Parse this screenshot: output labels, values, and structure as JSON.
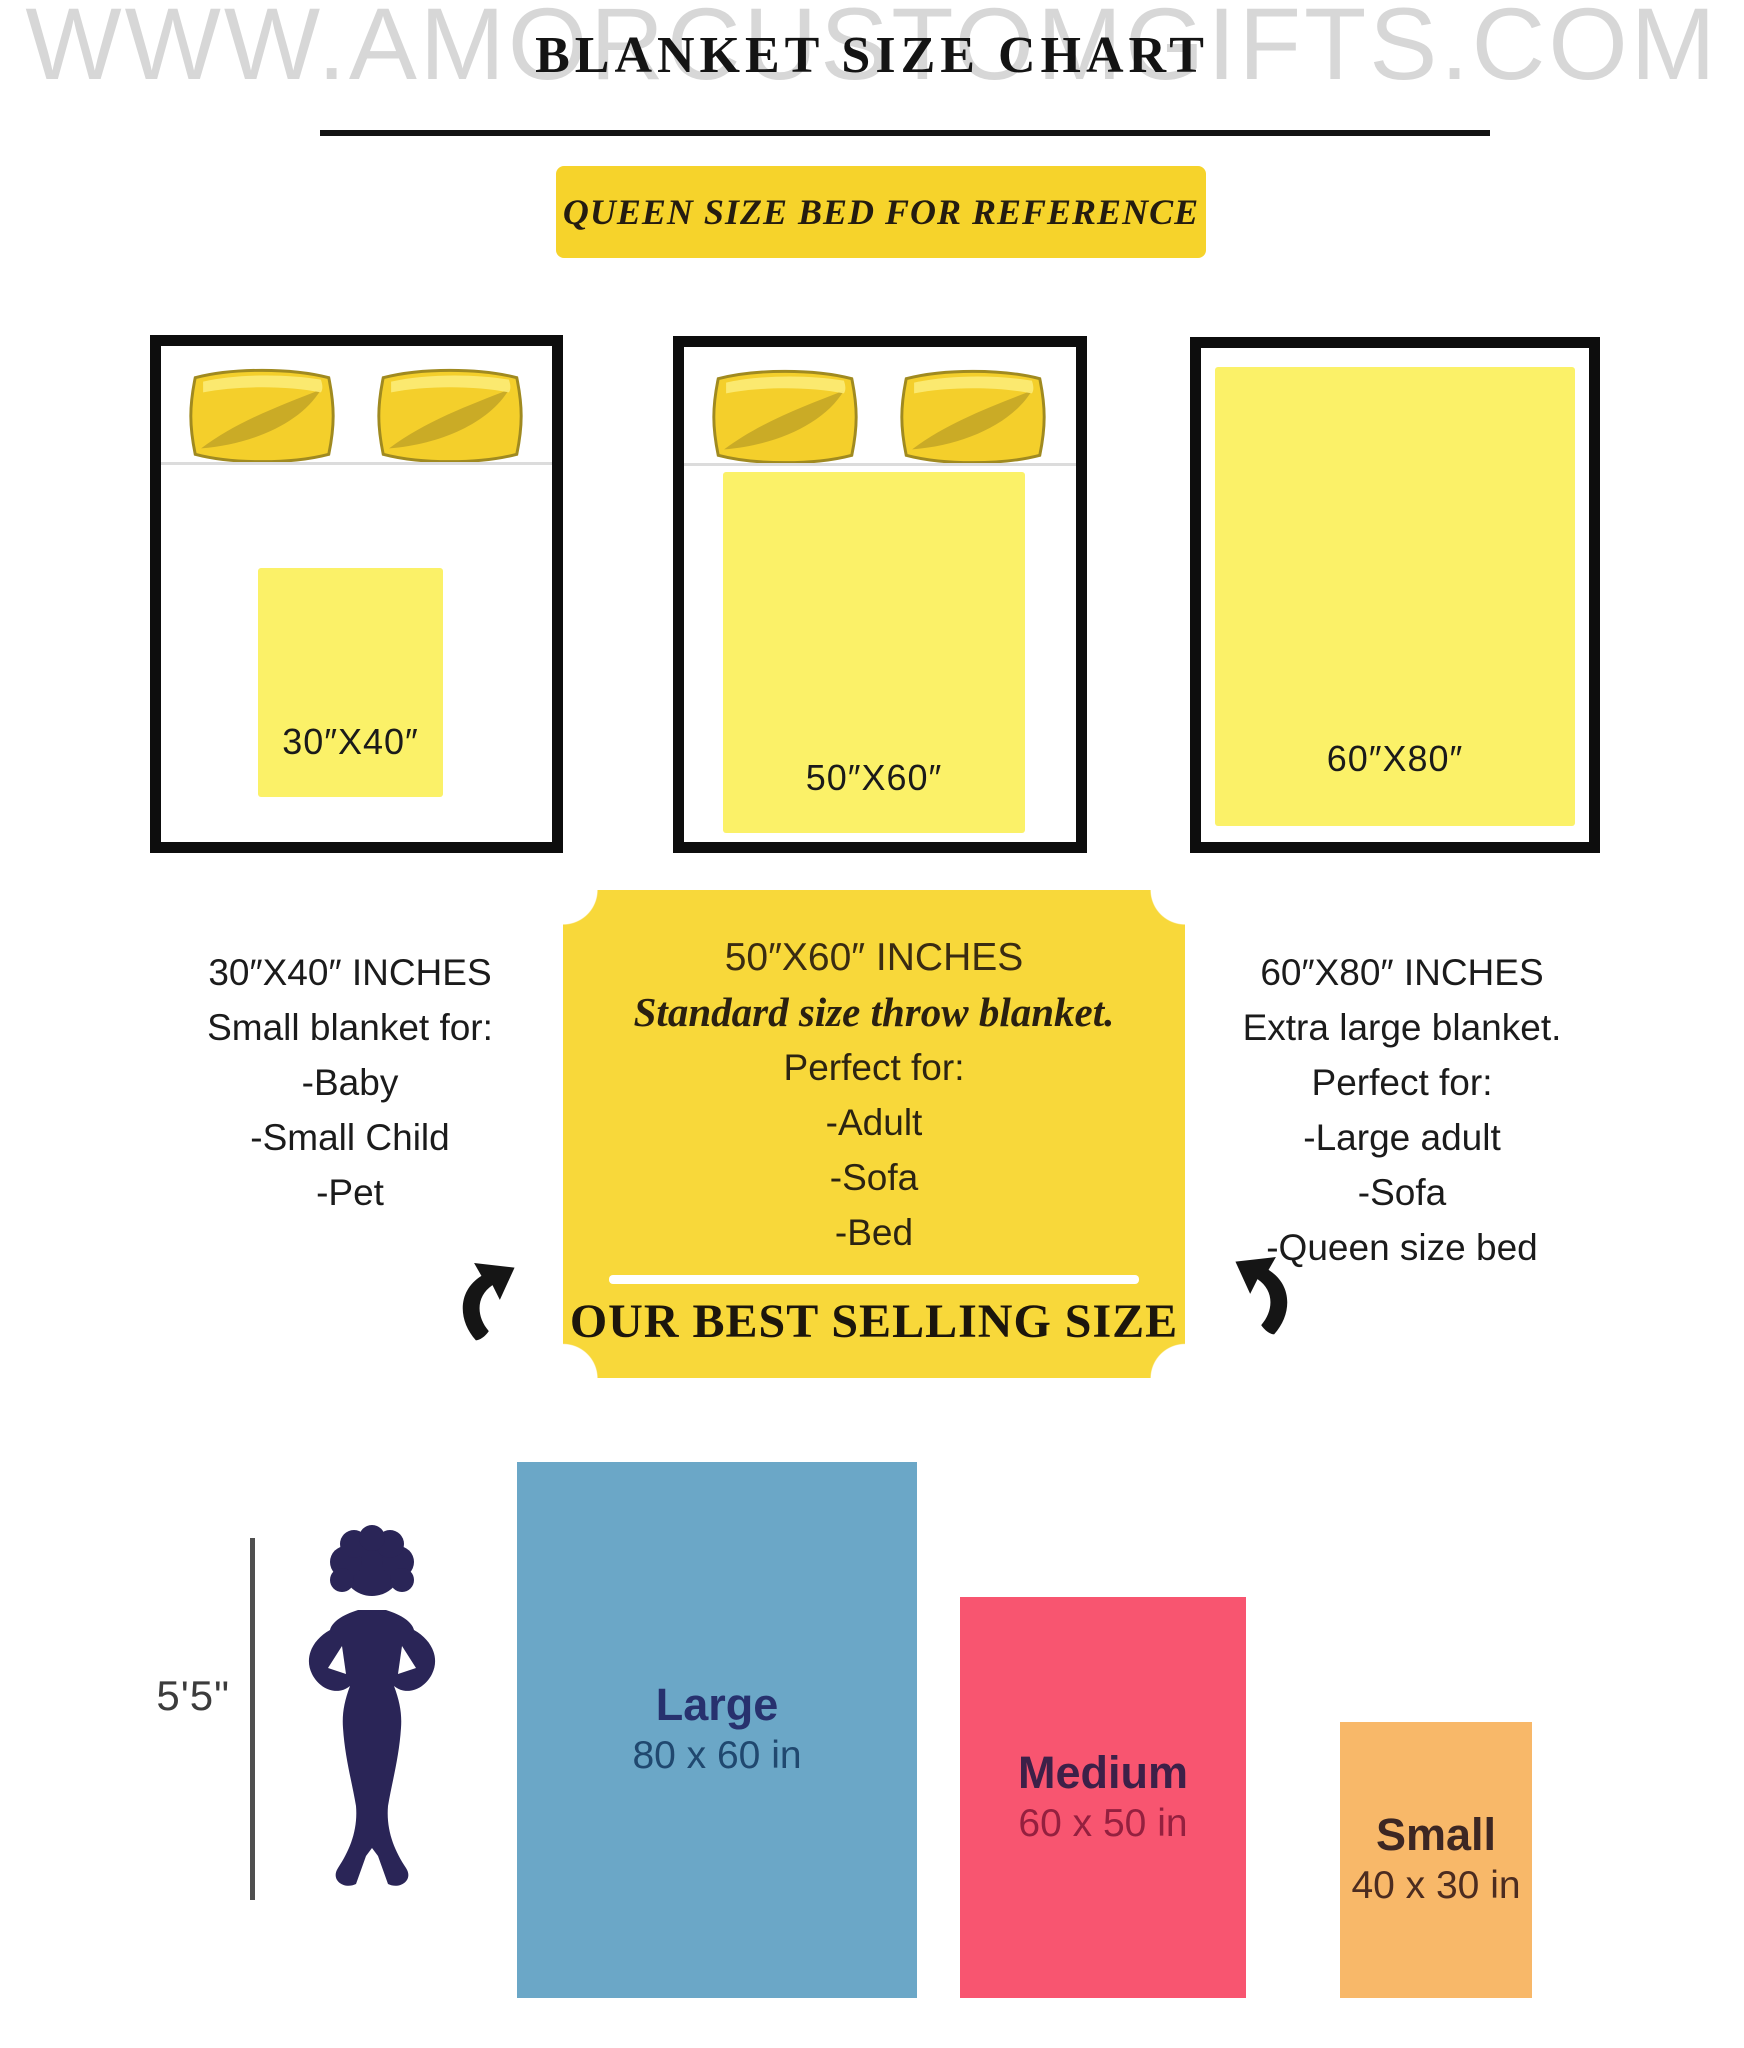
{
  "watermark": "WWW.AMORCUSTOMGIFTS.COM",
  "header": {
    "title": "BLANKET SIZE CHART",
    "banner": "QUEEN SIZE BED FOR REFERENCE"
  },
  "beds": [
    {
      "blanket_label": "30″X40″"
    },
    {
      "blanket_label": "50″X60″"
    },
    {
      "blanket_label": "60″X80″"
    }
  ],
  "notes": {
    "small": {
      "heading": "30″X40″ INCHES",
      "subheading": "Small blanket for:",
      "items": [
        "-Baby",
        "-Small Child",
        "-Pet"
      ]
    },
    "best": {
      "heading": "50″X60″ INCHES",
      "tagline": "Standard size throw blanket.",
      "intro": "Perfect for:",
      "items": [
        "-Adult",
        "-Sofa",
        "-Bed"
      ],
      "footer": "OUR BEST SELLING SIZE"
    },
    "xl": {
      "heading": "60″X80″ INCHES",
      "subheading": "Extra large blanket.",
      "intro": "Perfect for:",
      "items": [
        "-Large adult",
        "-Sofa",
        "-Queen size bed"
      ]
    }
  },
  "comparison": {
    "height_label": "5'5\"",
    "sizes": [
      {
        "name": "Large",
        "dims": "80 x 60 in",
        "color": "#6ba7c7"
      },
      {
        "name": "Medium",
        "dims": "60 x 50 in",
        "color": "#f85570"
      },
      {
        "name": "Small",
        "dims": "40 x 30 in",
        "color": "#f8b869"
      }
    ]
  },
  "colors": {
    "banner_yellow": "#f6d32b",
    "ticket_yellow": "#f8d83a",
    "blanket_yellow": "#fbf168",
    "pillow_yellow": "#f4cf2b",
    "large_blue": "#6ba7c7",
    "medium_pink": "#f85570",
    "small_orange": "#f8b869",
    "silhouette_navy": "#2a2557"
  }
}
